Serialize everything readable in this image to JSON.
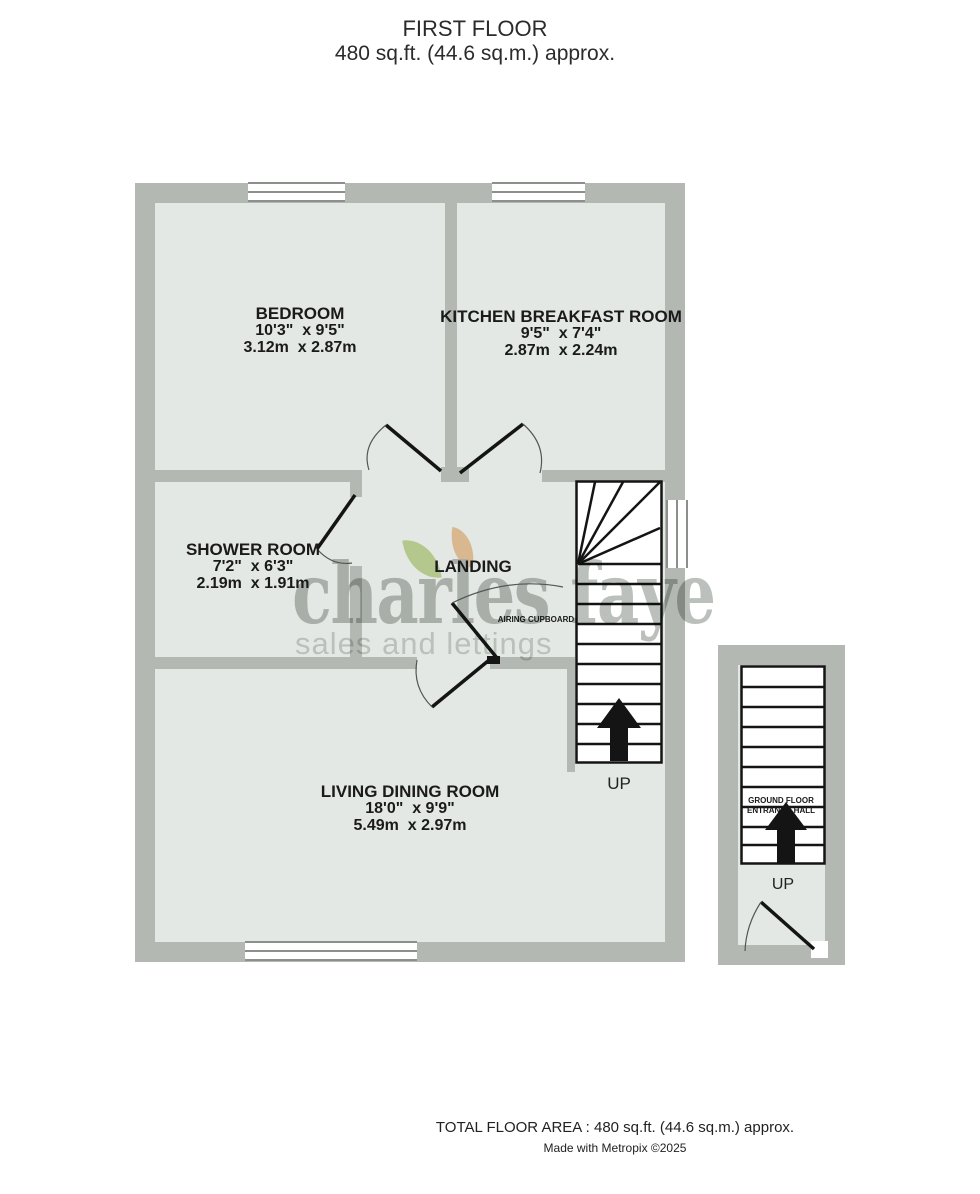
{
  "title": {
    "line1": "FIRST FLOOR",
    "line2": "480 sq.ft. (44.6 sq.m.) approx."
  },
  "rooms": {
    "bedroom": {
      "name": "BEDROOM",
      "imperial": "10'3\"  x 9'5\"",
      "metric": "3.12m  x 2.87m"
    },
    "kitchen": {
      "name": "KITCHEN BREAKFAST ROOM",
      "imperial": "9'5\"  x 7'4\"",
      "metric": "2.87m  x 2.24m"
    },
    "shower": {
      "name": "SHOWER ROOM",
      "imperial": "7'2\"  x 6'3\"",
      "metric": "2.19m  x 1.91m"
    },
    "living": {
      "name": "LIVING DINING ROOM",
      "imperial": "18'0\"  x 9'9\"",
      "metric": "5.49m  x 2.97m"
    },
    "landing": {
      "name": "LANDING"
    },
    "airing_cupboard": {
      "name": "AIRING CUPBOARD"
    },
    "ground_floor_hall": {
      "name": "GROUND FLOOR ENTRANCE HALL"
    }
  },
  "stairs": {
    "up_main": "UP",
    "up_entrance": "UP"
  },
  "watermark": {
    "brand": "charles faye",
    "tagline": "sales and lettings"
  },
  "footer": {
    "area": "TOTAL FLOOR AREA : 480 sq.ft. (44.6 sq.m.) approx.",
    "credit": "Made with Metropix ©2025"
  },
  "colors": {
    "wall": "#b3b8b3",
    "floor": "#e4e8e4",
    "line": "#141414",
    "leaf_green": "#cadb9e",
    "leaf_orange": "#f3cba1"
  }
}
